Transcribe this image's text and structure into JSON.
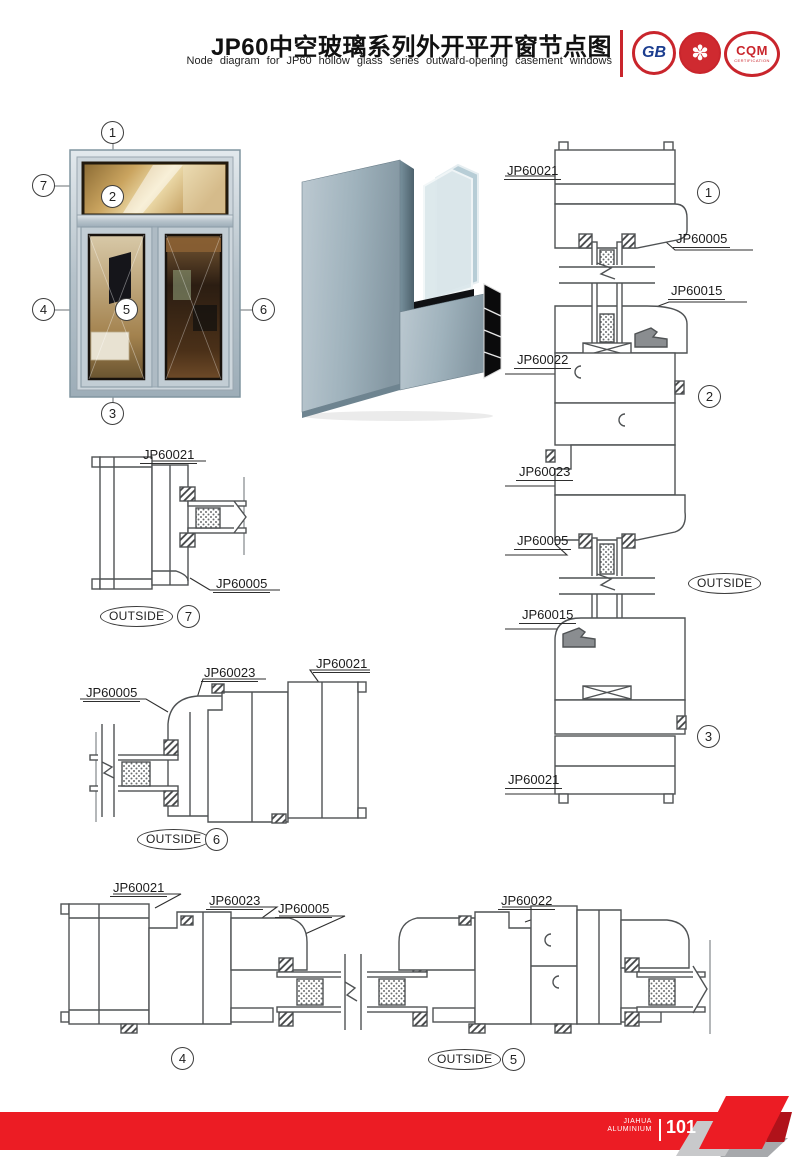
{
  "colors": {
    "accent_red": "#ec1c24",
    "logo_red": "#c9252c",
    "drawing_line": "#4f5254",
    "frame_aluminum": "#b7c3cb"
  },
  "header": {
    "title": "JP60中空玻璃系列外开平开窗节点图",
    "subtitle": "Node diagram for JP60 hollow glass series outward-opening casement windows",
    "logos": [
      {
        "label": "GB"
      },
      {
        "label": ""
      },
      {
        "label": "CQM",
        "sub": "CERTIFICATION"
      }
    ]
  },
  "icons": {
    "flower": "✽"
  },
  "elevation": {
    "callouts": [
      "1",
      "2",
      "3",
      "4",
      "5",
      "6",
      "7"
    ]
  },
  "section_right": {
    "labels": [
      "JP60021",
      "JP60005",
      "JP60015",
      "JP60022",
      "JP60023",
      "JP60005",
      "JP60015",
      "JP60021"
    ],
    "callouts": [
      "1",
      "2",
      "3"
    ],
    "outside": "OUTSIDE"
  },
  "detail_7": {
    "labels": [
      "JP60021",
      "JP60005"
    ],
    "outside": "OUTSIDE",
    "callout": "7"
  },
  "detail_6": {
    "labels": [
      "JP60005",
      "JP60023",
      "JP60021"
    ],
    "outside": "OUTSIDE",
    "callout": "6"
  },
  "detail_4_5": {
    "labels": [
      "JP60021",
      "JP60023",
      "JP60005",
      "JP60022"
    ],
    "callouts": [
      "4",
      "5"
    ],
    "outside": "OUTSIDE"
  },
  "footer": {
    "brand_line1": "JIAHUA",
    "brand_line2": "ALUMINIUM",
    "page_number": "101"
  }
}
